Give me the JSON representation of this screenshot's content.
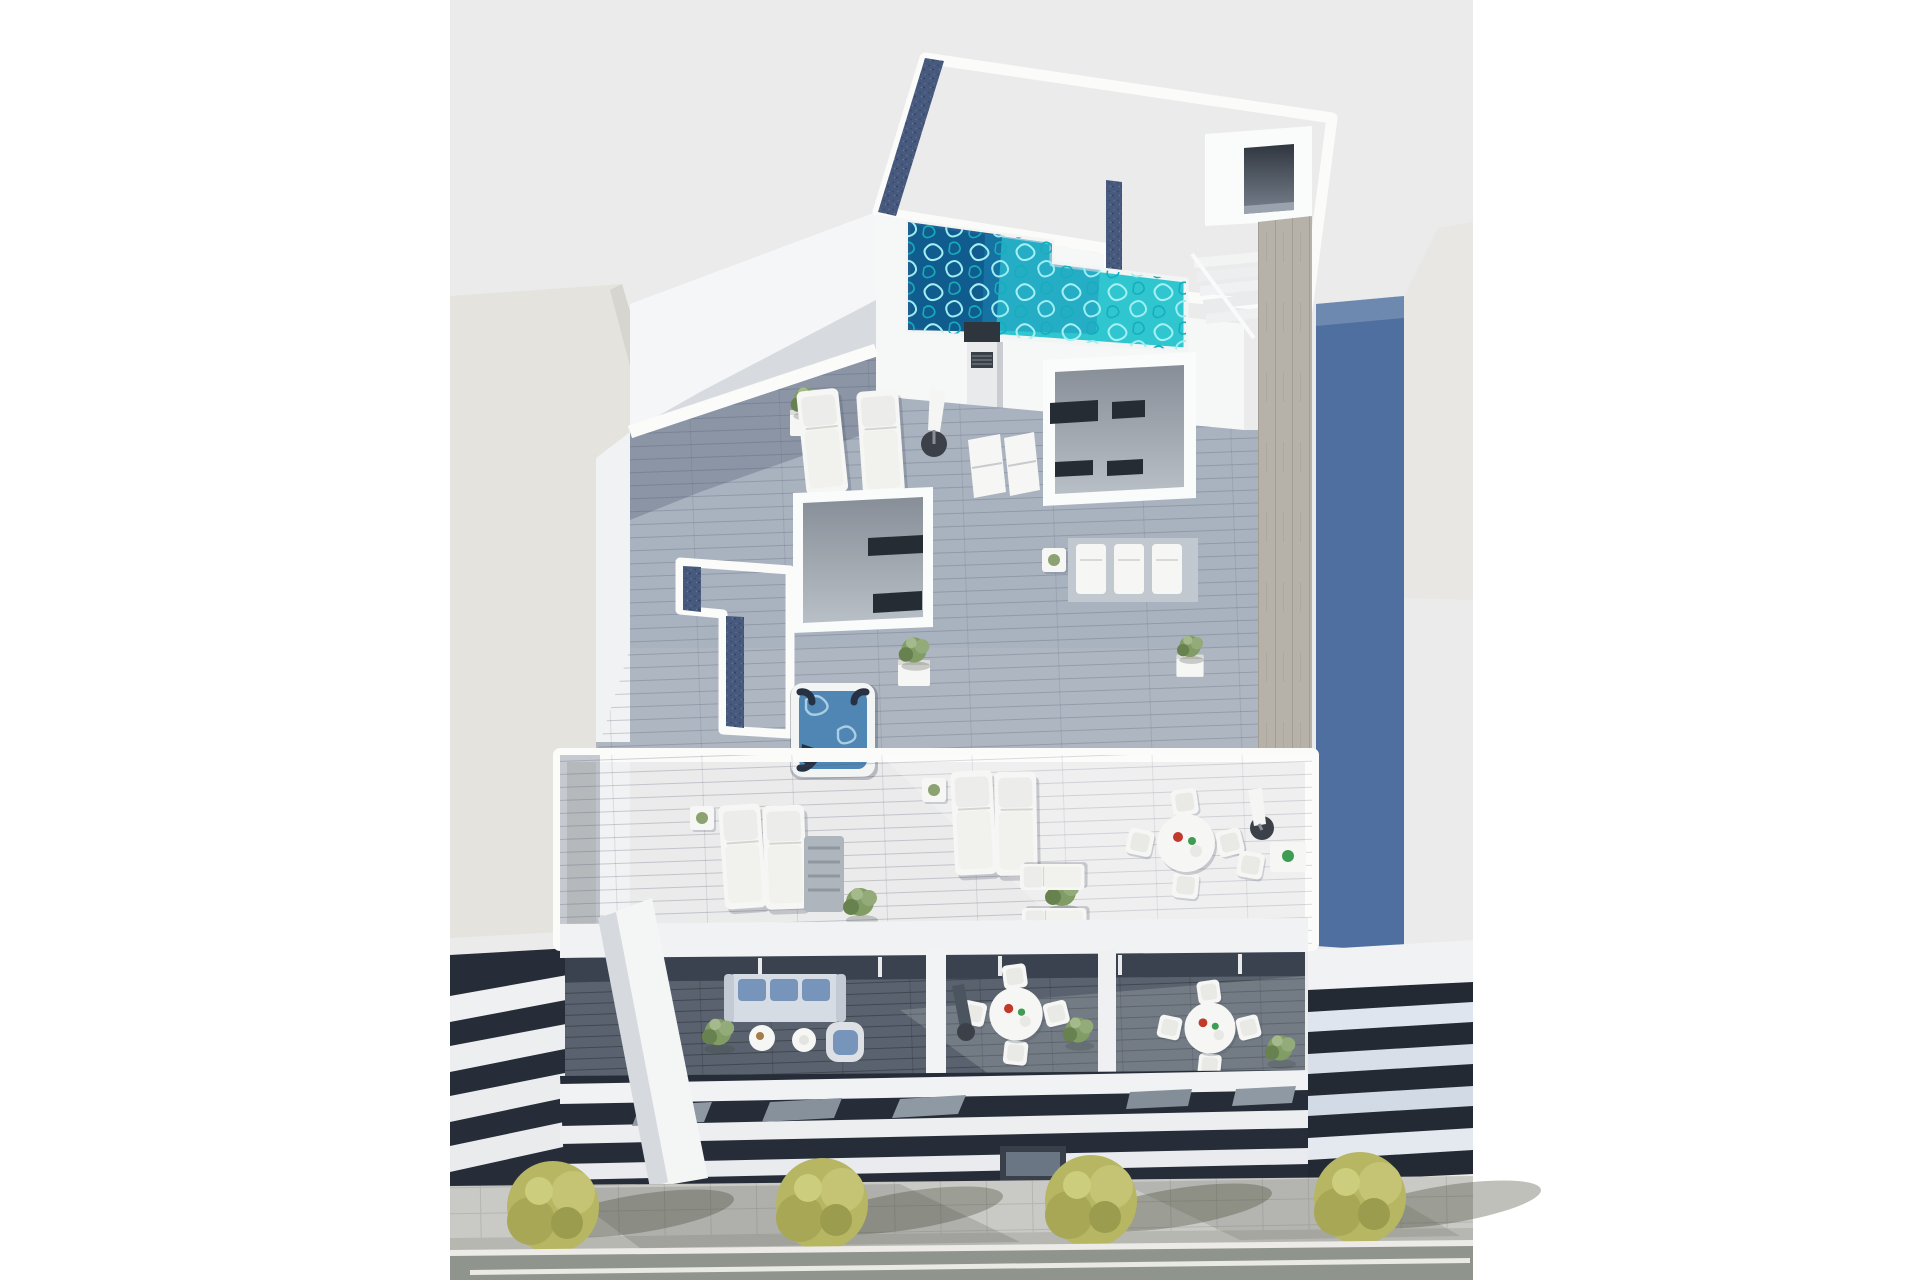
{
  "image": {
    "type": "architectural-3d-render",
    "view": "aerial-birds-eye",
    "subject": "Modern white apartment building with rooftop pool, jacuzzi and furnished terraces, flanked by neighbouring buildings and a tree-lined street",
    "text_content": "none"
  },
  "colors": {
    "canvas": "#ffffff",
    "sky": "#ebebec",
    "left_building_wall": "#e4e3de",
    "left_building_facet": "#d6d5d0",
    "white_wall": "#f5f6f7",
    "gravel_roof": "#d7d3ca",
    "gravel_speckle": "#bcb5a7",
    "roof_shadow_strip": "#47597d",
    "roof_shadow_speckle": "#36486b",
    "pool_water": "#2fc6d0",
    "pool_ripple": "#a5f0f2",
    "pool_deep_end": "#0f5288",
    "wood_walkway": "#b7b2a9",
    "deck_upper": "#a9b2bf",
    "deck_mid": "#aeb6c1",
    "deck_lower": "#b8bec7",
    "skylight_glass": "#262c33",
    "skylight_body": "#a7adb5",
    "jacuzzi_water": "#4f86b4",
    "jacuzzi_seat": "#263244",
    "balcony_glass_band": "#3a4250",
    "balcony_floor": "#59626e",
    "sofa_body": "#d6dce3",
    "cushion_blue": "#7795bb",
    "slab_white": "#f1f2f4",
    "slab_gap_dark": "#262d38",
    "right_building_wall_blue": "#4e6f9f",
    "right_building_roof": "#e8e7e3",
    "right_building_slab": "#dfe5ee",
    "sidewalk": "#c9c9c5",
    "curb": "#ecebe7",
    "road": "#8f948c",
    "road_marking": "#eaeae5",
    "street_tree": "#b7b663",
    "street_tree_shade": "#9c9c4e",
    "terrace_plant": "#829c66",
    "furniture_white": "#f6f6f4",
    "parasol_base": "#3c4149",
    "chimney_dark": "#2f353c"
  },
  "scene": {
    "buildings": {
      "main": "white multi-storey apartment building shown from above",
      "left_neighbour": "plain light-grey building with slatted lower levels",
      "right_neighbour": "building with dark blue side wall and slatted facade"
    },
    "rooftop": [
      "gravel flat roof",
      "L-shaped swimming pool",
      "pool steps",
      "access stair tower",
      "ventilation chimney",
      "skylight boxes",
      "wooden walkway"
    ],
    "upper_terrace": [
      "two sun loungers",
      "closed parasol with round base",
      "folding deck chairs",
      "planter"
    ],
    "middle_terrace": [
      "square jacuzzi hot tub",
      "gravel-topped lower roofs",
      "stacked spare loungers",
      "potted plants"
    ],
    "lower_terrace": [
      "two pairs of sun loungers",
      "side tables",
      "round dining table with four chairs",
      "bistro table and chair",
      "parasol with round base",
      "potted shrubs"
    ],
    "balconies": [
      "three-seat sofa with blue cushions",
      "round coffee tables",
      "armchair with blue cushion",
      "round dining tables with chairs",
      "closed parasol",
      "potted shrubs",
      "glass balustrade"
    ],
    "street": [
      "paved sidewalk",
      "four olive trees with long shadows",
      "kerb",
      "asphalt road with white lane marking"
    ]
  }
}
